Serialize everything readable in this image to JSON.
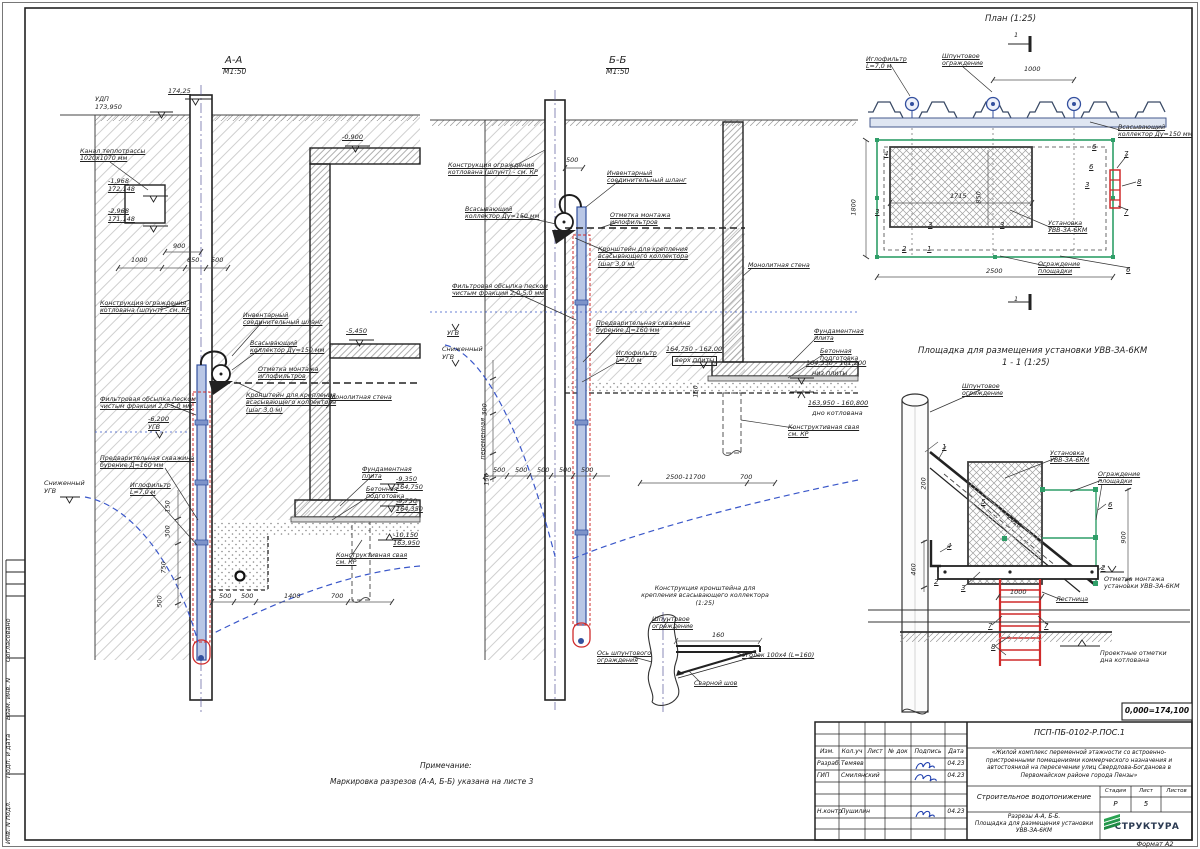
{
  "colors": {
    "pipe_blue": "#33509e",
    "casing_red": "#cf2b2b",
    "fence_green": "#2f9e68",
    "water_blue": "#3a57c9",
    "signature_blue": "#1f3fae",
    "logo_green": "#2aa353"
  },
  "side_strip": [
    {
      "t": "Согласовано",
      "x": 12,
      "y": 654
    },
    {
      "t": "Взам. инв. N",
      "x": 12,
      "y": 712
    },
    {
      "t": "Подп. и дата",
      "x": 12,
      "y": 770
    },
    {
      "t": "Инв. N подл.",
      "x": 12,
      "y": 836
    }
  ],
  "labels": [
    {
      "t": "А-А",
      "x": 222,
      "y": 55,
      "cls": "st"
    },
    {
      "t": "М1:50",
      "x": 223,
      "y": 68,
      "cls": "st2"
    },
    {
      "t": "174,25",
      "x": 168,
      "y": 88,
      "cls": "dim u"
    },
    {
      "t": "УДП\n173,950",
      "x": 95,
      "y": 96,
      "cls": "dim"
    },
    {
      "t": "Канал теплотрассы\n1020х1070 мм",
      "x": 80,
      "y": 148,
      "cls": "ann u"
    },
    {
      "t": "-1,968\n172,148",
      "x": 108,
      "y": 178,
      "cls": "dim u"
    },
    {
      "t": "-2,968\n171,148",
      "x": 108,
      "y": 208,
      "cls": "dim u"
    },
    {
      "t": "-0,900",
      "x": 342,
      "y": 134,
      "cls": "dim u"
    },
    {
      "t": "-5,450",
      "x": 346,
      "y": 328,
      "cls": "dim u"
    },
    {
      "t": "900",
      "x": 173,
      "y": 243,
      "cls": "dim"
    },
    {
      "t": "1000",
      "x": 131,
      "y": 257,
      "cls": "dim"
    },
    {
      "t": "650",
      "x": 187,
      "y": 257,
      "cls": "dim"
    },
    {
      "t": "500",
      "x": 211,
      "y": 257,
      "cls": "dim"
    },
    {
      "t": "Конструкция ограждения\nкотлована (шпунт) - см. КР",
      "x": 100,
      "y": 300,
      "cls": "ann u"
    },
    {
      "t": "Инвентарный\nсоединительный шланг",
      "x": 243,
      "y": 312,
      "cls": "ann u"
    },
    {
      "t": "Всасывающий\nколлектор Ду=150 мм",
      "x": 250,
      "y": 340,
      "cls": "ann u"
    },
    {
      "t": "Отметка монтажа\nиглофильтров",
      "x": 258,
      "y": 366,
      "cls": "ann u"
    },
    {
      "t": "Кронштейн для крепления\nвсасывающего коллектора\n(шаг 3,0 м)",
      "x": 246,
      "y": 392,
      "cls": "ann u"
    },
    {
      "t": "Фильтровая обсыпка песком\nчистым фракции 2,0-5,0 мм",
      "x": 100,
      "y": 396,
      "cls": "ann u"
    },
    {
      "t": "-6,200\nУГВ",
      "x": 148,
      "y": 416,
      "cls": "dim u"
    },
    {
      "t": "Предварительная скважина\nбурение Д=160 мм",
      "x": 100,
      "y": 455,
      "cls": "ann u"
    },
    {
      "t": "Иглофильтр\nL=7,0 м",
      "x": 130,
      "y": 482,
      "cls": "ann u"
    },
    {
      "t": "Сниженный\nУГВ",
      "x": 44,
      "y": 480,
      "cls": "dim"
    },
    {
      "t": "Монолитная стена",
      "x": 330,
      "y": 394,
      "cls": "ann u"
    },
    {
      "t": "Фундаментная\nплита",
      "x": 362,
      "y": 466,
      "cls": "ann u"
    },
    {
      "t": "Бетонная\nподготовка",
      "x": 366,
      "y": 486,
      "cls": "ann u"
    },
    {
      "t": "-9,350\n164,750",
      "x": 396,
      "y": 476,
      "cls": "dim u"
    },
    {
      "t": "-9,750\n164,350",
      "x": 396,
      "y": 498,
      "cls": "dim u"
    },
    {
      "t": "-10,150\n163,950",
      "x": 393,
      "y": 532,
      "cls": "dim u"
    },
    {
      "t": "Конструктивная свая\nсм. КР",
      "x": 336,
      "y": 552,
      "cls": "ann u"
    },
    {
      "t": "500",
      "x": 219,
      "y": 593,
      "cls": "dim"
    },
    {
      "t": "500",
      "x": 241,
      "y": 593,
      "cls": "dim"
    },
    {
      "t": "1400",
      "x": 284,
      "y": 593,
      "cls": "dim"
    },
    {
      "t": "700",
      "x": 331,
      "y": 593,
      "cls": "dim"
    },
    {
      "t": "150",
      "x": 172,
      "y": 505,
      "cls": "dim rot"
    },
    {
      "t": "300",
      "x": 172,
      "y": 530,
      "cls": "dim rot"
    },
    {
      "t": "750",
      "x": 168,
      "y": 566,
      "cls": "dim rot"
    },
    {
      "t": "500",
      "x": 164,
      "y": 600,
      "cls": "dim rot"
    },
    {
      "t": "Б-Б",
      "x": 606,
      "y": 55,
      "cls": "st"
    },
    {
      "t": "М1:50",
      "x": 606,
      "y": 68,
      "cls": "st2"
    },
    {
      "t": "Конструкция ограждения\nкотлована (шпунт) - см. КР",
      "x": 448,
      "y": 162,
      "cls": "ann u"
    },
    {
      "t": "500",
      "x": 566,
      "y": 157,
      "cls": "dim"
    },
    {
      "t": "Инвентарный\nсоединительный шланг",
      "x": 607,
      "y": 170,
      "cls": "ann u"
    },
    {
      "t": "Всасывающий\nколлектор Ду=150 мм",
      "x": 465,
      "y": 206,
      "cls": "ann u"
    },
    {
      "t": "Отметка монтажа\nиглофильтров",
      "x": 610,
      "y": 212,
      "cls": "ann u"
    },
    {
      "t": "Кронштейн для крепления\nвсасывающего коллектора\n(шаг 3,0 м)",
      "x": 598,
      "y": 246,
      "cls": "ann u"
    },
    {
      "t": "Фильтровая обсыпка песком\nчистым фракции 2,0-5,0 мм",
      "x": 452,
      "y": 283,
      "cls": "ann u"
    },
    {
      "t": "Монолитная стена",
      "x": 748,
      "y": 262,
      "cls": "ann u"
    },
    {
      "t": "УГВ",
      "x": 447,
      "y": 330,
      "cls": "dim u"
    },
    {
      "t": "Сниженный\nУГВ",
      "x": 442,
      "y": 346,
      "cls": "dim"
    },
    {
      "t": "Предварительная скважина\nбурение Д=160 мм",
      "x": 596,
      "y": 320,
      "cls": "ann u"
    },
    {
      "t": "Иглофильтр\nL=7,0 м",
      "x": 616,
      "y": 350,
      "cls": "ann u"
    },
    {
      "t": "164,750 - 162,00",
      "x": 666,
      "y": 346,
      "cls": "dim u"
    },
    {
      "t": "верх плиты",
      "x": 672,
      "y": 356,
      "cls": "dim box"
    },
    {
      "t": "164,350 - 161,200",
      "x": 806,
      "y": 360,
      "cls": "dim u"
    },
    {
      "t": "низ плиты",
      "x": 812,
      "y": 370,
      "cls": "dim"
    },
    {
      "t": "163,950 - 160,800",
      "x": 808,
      "y": 400,
      "cls": "dim u"
    },
    {
      "t": "дно котлована",
      "x": 812,
      "y": 410,
      "cls": "dim"
    },
    {
      "t": "Фундаментная\nплита",
      "x": 814,
      "y": 328,
      "cls": "ann u"
    },
    {
      "t": "Бетонная\nподготовка",
      "x": 820,
      "y": 348,
      "cls": "ann u"
    },
    {
      "t": "Конструктивная свая\nсм. КР",
      "x": 788,
      "y": 424,
      "cls": "ann u"
    },
    {
      "t": "500",
      "x": 493,
      "y": 467,
      "cls": "dim"
    },
    {
      "t": "500",
      "x": 515,
      "y": 467,
      "cls": "dim"
    },
    {
      "t": "500",
      "x": 537,
      "y": 467,
      "cls": "dim"
    },
    {
      "t": "500",
      "x": 559,
      "y": 467,
      "cls": "dim"
    },
    {
      "t": "500",
      "x": 581,
      "y": 467,
      "cls": "dim"
    },
    {
      "t": "2500-11700",
      "x": 666,
      "y": 474,
      "cls": "dim"
    },
    {
      "t": "700",
      "x": 740,
      "y": 474,
      "cls": "dim"
    },
    {
      "t": "300",
      "x": 489,
      "y": 408,
      "cls": "dim rot"
    },
    {
      "t": "переменная",
      "x": 487,
      "y": 452,
      "cls": "dim rot"
    },
    {
      "t": "150",
      "x": 491,
      "y": 478,
      "cls": "dim rot"
    },
    {
      "t": "150",
      "x": 700,
      "y": 390,
      "cls": "dim rot"
    },
    {
      "t": "План (1:25)",
      "x": 985,
      "y": 14,
      "cls": "pt"
    },
    {
      "t": "1",
      "x": 1014,
      "y": 32,
      "cls": "dim"
    },
    {
      "t": "1",
      "x": 1014,
      "y": 296,
      "cls": "dim"
    },
    {
      "t": "Иглофильтр\nL=7,0 м",
      "x": 866,
      "y": 56,
      "cls": "ann u"
    },
    {
      "t": "Шпунтовое\nограждение",
      "x": 942,
      "y": 53,
      "cls": "ann u"
    },
    {
      "t": "1000",
      "x": 1024,
      "y": 66,
      "cls": "dim"
    },
    {
      "t": "Всасывающий\nколлектор Ду=150 мм",
      "x": 1118,
      "y": 124,
      "cls": "ann u"
    },
    {
      "t": "Установка\nУВВ-ЗА-6КМ",
      "x": 1048,
      "y": 220,
      "cls": "ann u"
    },
    {
      "t": "Ограждение\nплощадки",
      "x": 1038,
      "y": 261,
      "cls": "ann u"
    },
    {
      "t": "1800",
      "x": 858,
      "y": 208,
      "cls": "dim rot"
    },
    {
      "t": "850",
      "x": 983,
      "y": 196,
      "cls": "dim rot"
    },
    {
      "t": "1715",
      "x": 950,
      "y": 193,
      "cls": "dim"
    },
    {
      "t": "2500",
      "x": 986,
      "y": 268,
      "cls": "dim"
    },
    {
      "t": "4",
      "x": 884,
      "y": 150,
      "cls": "co"
    },
    {
      "t": "6",
      "x": 1092,
      "y": 143,
      "cls": "co"
    },
    {
      "t": "6",
      "x": 1089,
      "y": 163,
      "cls": "co"
    },
    {
      "t": "3",
      "x": 1085,
      "y": 181,
      "cls": "co"
    },
    {
      "t": "8",
      "x": 1137,
      "y": 178,
      "cls": "co"
    },
    {
      "t": "7",
      "x": 1124,
      "y": 150,
      "cls": "co"
    },
    {
      "t": "7",
      "x": 1124,
      "y": 208,
      "cls": "co"
    },
    {
      "t": "3",
      "x": 875,
      "y": 208,
      "cls": "co"
    },
    {
      "t": "3",
      "x": 928,
      "y": 221,
      "cls": "co"
    },
    {
      "t": "3",
      "x": 1000,
      "y": 221,
      "cls": "co"
    },
    {
      "t": "2",
      "x": 902,
      "y": 245,
      "cls": "co"
    },
    {
      "t": "1",
      "x": 927,
      "y": 245,
      "cls": "co"
    },
    {
      "t": "6",
      "x": 1126,
      "y": 266,
      "cls": "co"
    },
    {
      "t": "Площадка для размещения установки УВВ-ЗА-6КМ",
      "x": 918,
      "y": 346,
      "cls": "pt"
    },
    {
      "t": "1 - 1 (1:25)",
      "x": 1002,
      "y": 358,
      "cls": "pt"
    },
    {
      "t": "Шпунтовое\nограждение",
      "x": 962,
      "y": 383,
      "cls": "ann u"
    },
    {
      "t": "Установка\nУВВ-ЗА-6КМ",
      "x": 1050,
      "y": 450,
      "cls": "ann u"
    },
    {
      "t": "Ограждение\nплощадки",
      "x": 1098,
      "y": 471,
      "cls": "ann u"
    },
    {
      "t": "200",
      "x": 928,
      "y": 482,
      "cls": "dim rot"
    },
    {
      "t": "2020",
      "x": 1010,
      "y": 514,
      "cls": "dim rot45"
    },
    {
      "t": "900",
      "x": 1128,
      "y": 536,
      "cls": "dim rot"
    },
    {
      "t": "460",
      "x": 918,
      "y": 568,
      "cls": "dim rot"
    },
    {
      "t": "1000",
      "x": 1010,
      "y": 589,
      "cls": "dim"
    },
    {
      "t": "Лестница",
      "x": 1056,
      "y": 596,
      "cls": "ann u"
    },
    {
      "t": "Отметка монтажа\nустановки УВВ-ЗА-6КМ",
      "x": 1104,
      "y": 576,
      "cls": "ann"
    },
    {
      "t": "Проектные отметки\nдна котлована",
      "x": 1100,
      "y": 650,
      "cls": "ann"
    },
    {
      "t": "1",
      "x": 942,
      "y": 443,
      "cls": "co"
    },
    {
      "t": "5",
      "x": 981,
      "y": 498,
      "cls": "co"
    },
    {
      "t": "6",
      "x": 1108,
      "y": 501,
      "cls": "co"
    },
    {
      "t": "4",
      "x": 947,
      "y": 542,
      "cls": "co"
    },
    {
      "t": "2",
      "x": 934,
      "y": 578,
      "cls": "co"
    },
    {
      "t": "3",
      "x": 961,
      "y": 584,
      "cls": "co"
    },
    {
      "t": "2",
      "x": 1101,
      "y": 564,
      "cls": "co"
    },
    {
      "t": "7",
      "x": 988,
      "y": 622,
      "cls": "co"
    },
    {
      "t": "7",
      "x": 1044,
      "y": 622,
      "cls": "co"
    },
    {
      "t": "8",
      "x": 991,
      "y": 643,
      "cls": "co"
    },
    {
      "t": "Конструкция кронштейна для\nкрепления всасывающего коллектора\n(1:25)",
      "x": 630,
      "y": 585,
      "w": 150,
      "cls": "ann ctr"
    },
    {
      "t": "Шпунтовое\nограждение",
      "x": 652,
      "y": 616,
      "cls": "ann u"
    },
    {
      "t": "Ось шпунтового\nограждения",
      "x": 597,
      "y": 650,
      "cls": "ann u"
    },
    {
      "t": "Уголок 100х4 (L=160)",
      "x": 742,
      "y": 652,
      "cls": "ann u"
    },
    {
      "t": "Сварной шов",
      "x": 694,
      "y": 680,
      "cls": "ann u"
    },
    {
      "t": "160",
      "x": 712,
      "y": 632,
      "cls": "dim"
    },
    {
      "t": "Примечание:",
      "x": 420,
      "y": 762,
      "cls": "note"
    },
    {
      "t": "Маркировка разрезов (А-А, Б-Б) указана на листе 3",
      "x": 330,
      "y": 778,
      "cls": "note"
    }
  ],
  "titleblock": {
    "datum": "0,000=174,100",
    "doc_number": "ПСП-ПБ-0102-Р.ПОС.1",
    "project": "«Жилой комплекс переменной этажности со встроенно-пристроенными помещениями коммерческого  назначения и автостоянкой на пересечении улиц Свердлова-Богданова  в Первомайском районе города Пензы»",
    "cols": {
      "izm": "Изм.",
      "kol": "Кол.уч",
      "list": "Лист",
      "doc": "№ док",
      "sign": "Подпись",
      "date": "Дата"
    },
    "rows": [
      {
        "role": "Разраб.",
        "name": "Темяев",
        "date": "04.23"
      },
      {
        "role": "ГИП",
        "name": "Смилянский",
        "date": "04.23"
      },
      {
        "role": "Н.контр.",
        "name": "Пушилин",
        "date": "04.23"
      }
    ],
    "subject": "Строительное водопонижение",
    "sheet_title": "Разрезы А-А, Б-Б.\nПлощадка для размещения установки\nУВВ-ЗА-6КМ",
    "stage_label": "Стадия",
    "sheet_label": "Лист",
    "sheets_label": "Листов",
    "stage": "Р",
    "sheet": "5",
    "sheets": "",
    "logo": "СТРУКТУРА",
    "format": "Формат А2"
  }
}
